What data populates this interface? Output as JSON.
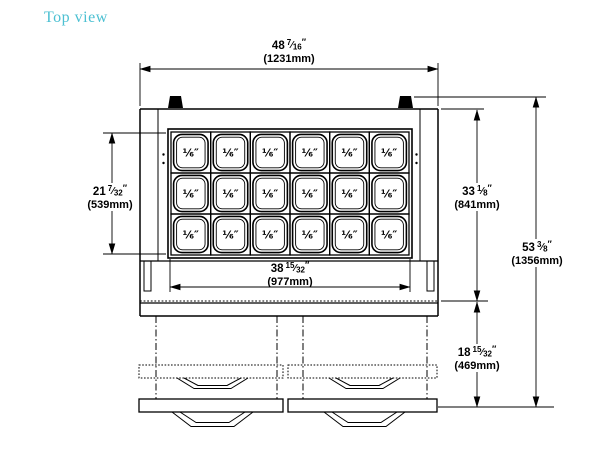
{
  "title": "Top view",
  "colors": {
    "title_text": "#4cc0d2",
    "line": "#000000",
    "background": "#ffffff"
  },
  "symbols": {
    "fraction_slash": "⁄",
    "inch_mark": "″"
  },
  "pan_grid": {
    "rows": 3,
    "cols": 6,
    "pan_label": "⅙″"
  },
  "dimensions": {
    "overall_width": {
      "whole": "48",
      "num": "7",
      "den": "16",
      "mm": "(1231mm)"
    },
    "pan_area_depth": {
      "whole": "21",
      "num": "7",
      "den": "32",
      "mm": "(539mm)"
    },
    "pan_area_width": {
      "whole": "38",
      "num": "15",
      "den": "32",
      "mm": "(977mm)"
    },
    "body_depth": {
      "whole": "33",
      "num": "1",
      "den": "8",
      "mm": "(841mm)"
    },
    "base_depth": {
      "whole": "18",
      "num": "15",
      "den": "32",
      "mm": "(469mm)"
    },
    "overall_depth": {
      "whole": "53",
      "num": "3",
      "den": "8",
      "mm": "(1356mm)"
    }
  }
}
